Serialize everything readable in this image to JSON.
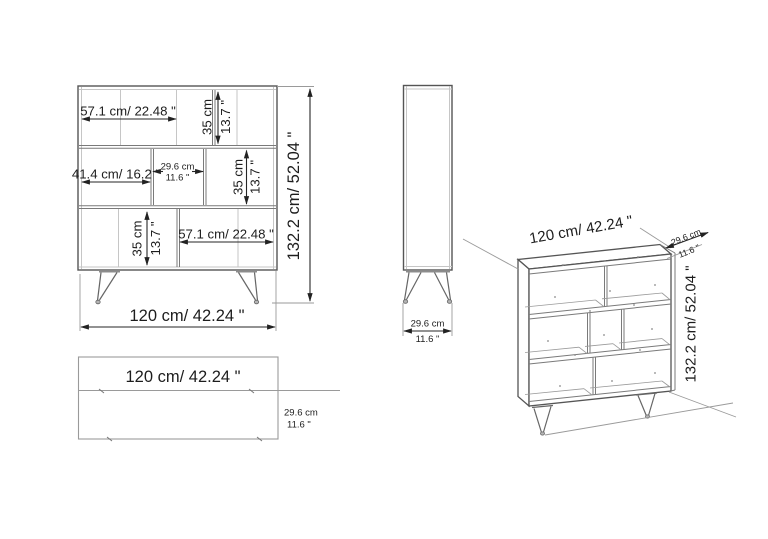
{
  "colors": {
    "background": "#ffffff",
    "line": "#555555",
    "light_line": "#c6c6c6",
    "dimension_text": "#1d1d1d"
  },
  "front_view": {
    "row1_width": "57.1 cm/ 22.48 \"",
    "row1_height_cm": "35 cm",
    "row1_height_in": "13.7 \"",
    "row2_width": "41.4 cm/ 16.2 \"",
    "row2_mid_cm": "29.6 cm",
    "row2_mid_in": "11.6 \"",
    "row2_height_cm": "35 cm",
    "row2_height_in": "13.7 \"",
    "row3_height_cm": "35 cm",
    "row3_height_in": "13.7 \"",
    "row3_width": "57.1 cm/ 22.48 \"",
    "overall_height": "132.2 cm/ 52.04 \"",
    "overall_width": "120 cm/ 42.24 \""
  },
  "side_view": {
    "depth_cm": "29.6 cm",
    "depth_in": "11.6 \""
  },
  "top_view": {
    "width": "120 cm/ 42.24 \"",
    "depth_cm": "29.6 cm",
    "depth_in": "11.6 \""
  },
  "iso_view": {
    "width": "120 cm/ 42.24 \"",
    "depth_cm": "29.6 cm",
    "depth_in": "11.6 \"",
    "height": "132.2 cm/ 52.04 \""
  }
}
